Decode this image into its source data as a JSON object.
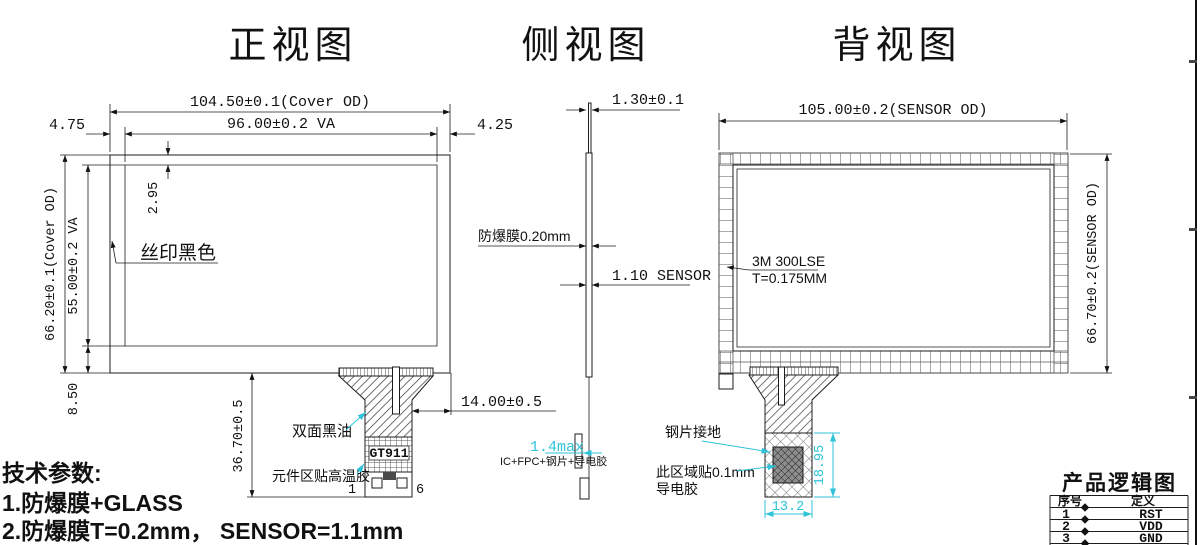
{
  "titles": {
    "front": "正视图",
    "side": "侧视图",
    "back": "背视图"
  },
  "front": {
    "dim_cover_w": "104.50±0.1(Cover OD)",
    "dim_va_w": "96.00±0.2 VA",
    "dim_left": "4.75",
    "dim_right": "4.25",
    "dim_cover_h": "66.20±0.1(Cover OD)",
    "dim_va_h": "55.00±0.2 VA",
    "dim_top": "2.95",
    "dim_bottom": "8.50",
    "dim_tail": "36.70±0.5",
    "dim_tail_offset": "14.00±0.5",
    "label_silk": "丝印黑色",
    "label_oil": "双面黑油",
    "label_ic": "GT911",
    "label_tape": "元件区贴高温胶",
    "pin_first": "1",
    "pin_last": "6"
  },
  "side": {
    "dim_total": "1.30±0.1",
    "label_film": "防爆膜0.20mm",
    "dim_sensor": "1.10 SENSOR",
    "dim_stack": "1.4max",
    "label_stack": "IC+FPC+钢片+导电胶"
  },
  "back": {
    "dim_w": "105.00±0.2(SENSOR OD)",
    "dim_h": "66.70±0.2(SENSOR OD)",
    "label_adh1": "3M 300LSE",
    "label_adh2": "T=0.175MM",
    "label_ground": "钢片接地",
    "label_cond1": "此区域贴0.1mm",
    "label_cond2": "导电胶",
    "dim_steel_h": "18.95",
    "dim_steel_w": "13.2"
  },
  "tech": {
    "title": "技术参数:",
    "line1": "1.防爆膜+GLASS",
    "line2": "2.防爆膜T=0.2mm， SENSOR=1.1mm"
  },
  "table": {
    "title": "产品逻辑图",
    "col_no": "序号",
    "col_def": "定义",
    "rows": [
      {
        "no": "1",
        "def": "RST"
      },
      {
        "no": "2",
        "def": "VDD"
      },
      {
        "no": "3",
        "def": "GND"
      }
    ]
  },
  "colors": {
    "line": "#1c1c1c",
    "accent": "#2ec3d9"
  }
}
